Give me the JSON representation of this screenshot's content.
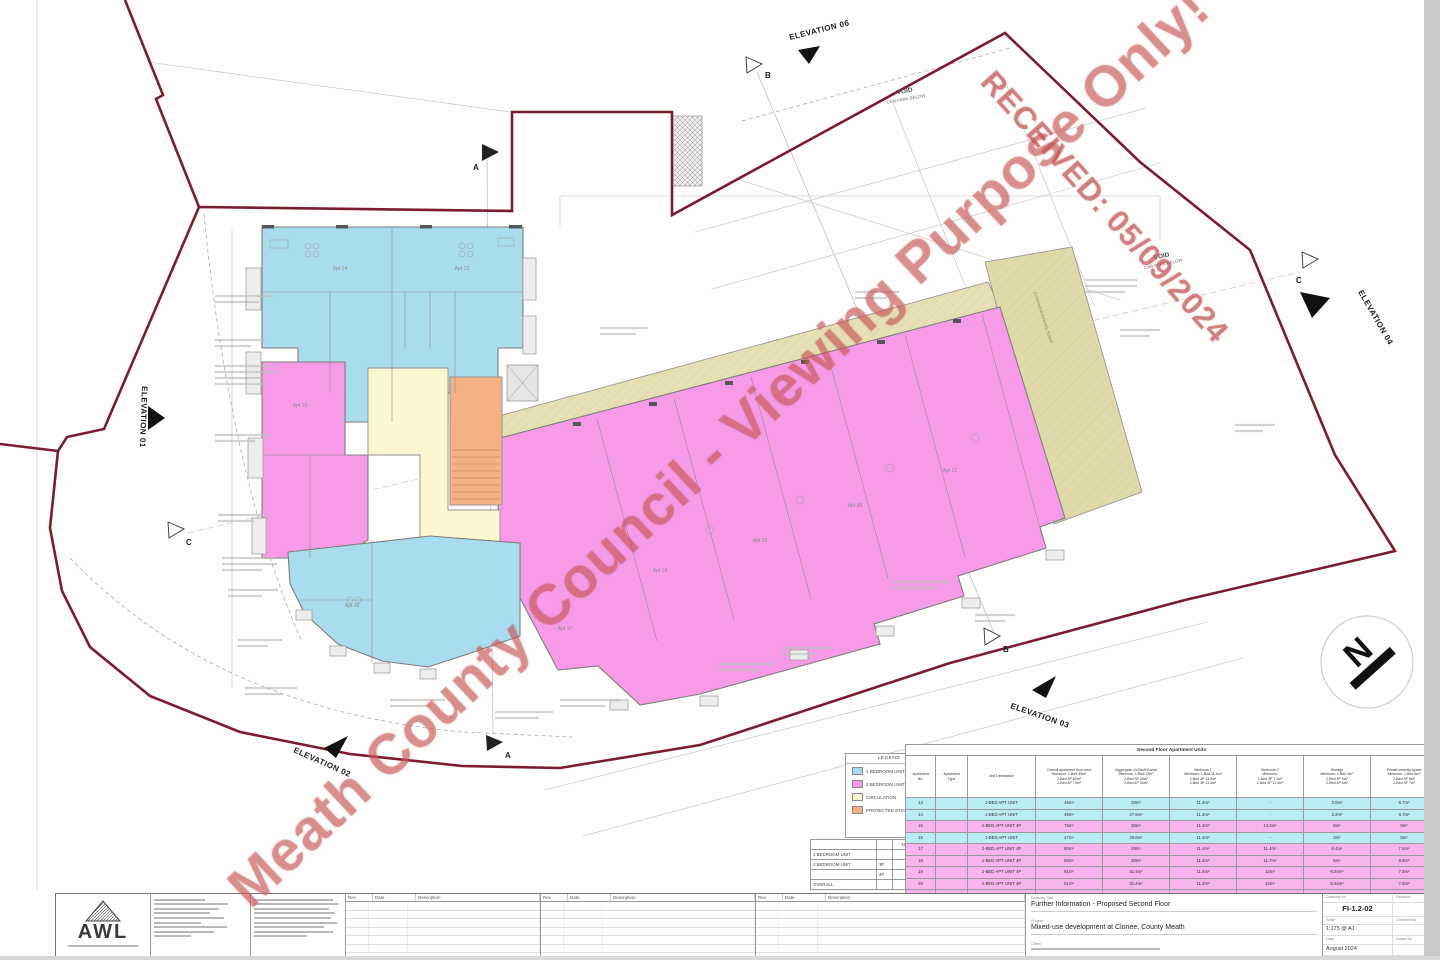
{
  "watermarks": {
    "main": "Meath County Council - Viewing Purpose Only!",
    "received": "RECEIVED: 05/09/2024"
  },
  "plan": {
    "void_title": "VOID",
    "void_sub": "CAR PARK BELOW",
    "elevation_01": "ELEVATION 01",
    "elevation_02": "ELEVATION 02",
    "elevation_03": "ELEVATION 03",
    "elevation_04": "ELEVATION 04",
    "elevation_06": "ELEVATION 06",
    "section_a": "A",
    "section_b": "B",
    "section_c": "C",
    "north_label": "N",
    "communal_label": "Communal Amenity Space",
    "units": [
      "Apt 14",
      "Apt 13",
      "Apt 15",
      "Apt 16",
      "Apt 17",
      "Apt 18",
      "Apt 19",
      "Apt 20",
      "Apt 21"
    ]
  },
  "legend": {
    "title": "LEGEND",
    "items": [
      {
        "label": "1 BEDROOM UNIT",
        "color": "#aadcf0"
      },
      {
        "label": "2 BEDROOM UNIT",
        "color": "#f79be8"
      },
      {
        "label": "CIRCULATION",
        "color": "#fbf7d0"
      },
      {
        "label": "PROTECTED STAIRWAY",
        "color": "#f5b183"
      }
    ]
  },
  "summary": {
    "number_header": "NUMBER",
    "rows": [
      [
        "1 BEDROOM UNIT",
        "",
        "3 No."
      ],
      [
        "2 BEDROOM UNIT",
        "3P",
        "1 No."
      ],
      [
        "",
        "4P",
        "5 No."
      ],
      [
        "OVERALL",
        "",
        "9 No."
      ]
    ]
  },
  "schedule": {
    "title": "Second Floor Apartment Units",
    "columns": [
      "Apartment\nNo.",
      "Apartment\nType",
      "Unit Description",
      "Overall apartment floor area\nMinimum: 1-Bed 45m²\n2-Bed 3P 63m²\n2-Bed 4P 73m²",
      "Aggregate Liv/Din/Kit area\nMinimum: 1-Bed 23m²\n2-Bed 3P 28m²\n2-Bed 4P 30m²",
      "Bedroom 1\nMinimum: 1-Bed 11.4m²\n2-Bed 3P 11.4m²\n2-Bed 4P 11.4m²",
      "Bedroom 2\nMinimum:\n2-Bed 3P 7.1m²\n2-Bed 4P 11.4m²",
      "Storage\nMinimum: 1-Bed 3m²\n2-Bed 3P 5m²\n2-Bed 4P 6m²",
      "Private amenity space\nMinimum: 1-Bed 5m²\n2-Bed 3P 6m²\n2-Bed 4P 7m²"
    ],
    "rows": [
      {
        "tint": "blue",
        "cells": [
          "13",
          "",
          "1-BED APT UNIT",
          "46m²",
          "28m²",
          "11.4m²",
          "-",
          "3.0m²",
          "5.7m²"
        ]
      },
      {
        "tint": "blue",
        "cells": [
          "14",
          "",
          "1-BED APT UNIT",
          "46m²",
          "27.5m²",
          "11.4m²",
          "-",
          "3.2m²",
          "5.7m²"
        ]
      },
      {
        "tint": "pink",
        "cells": [
          "15",
          "",
          "2-BED APT UNIT 4P",
          "75m²",
          "30m²",
          "11.4m²",
          "13.2m²",
          "6m²",
          "9m²"
        ]
      },
      {
        "tint": "blue",
        "cells": [
          "16",
          "",
          "1-BED APT UNIT",
          "47m²",
          "26.6m²",
          "11.4m²",
          "-",
          "3m²",
          "5m²"
        ]
      },
      {
        "tint": "pink",
        "cells": [
          "17",
          "",
          "2-BED APT UNIT 4P",
          "80m²",
          "28m²",
          "11.4m²",
          "11.4m²",
          "6.4m²",
          "7.8m²"
        ]
      },
      {
        "tint": "pink",
        "cells": [
          "18",
          "",
          "2-BED APT UNIT 4P",
          "80m²",
          "30m²",
          "11.4m²",
          "11.7m²",
          "6m²",
          "9.8m²"
        ]
      },
      {
        "tint": "pink",
        "cells": [
          "19",
          "",
          "2-BED APT UNIT 4P",
          "81m²",
          "31.4m²",
          "11.4m²",
          "12m²",
          "6.24m²",
          "7.5m²"
        ]
      },
      {
        "tint": "pink",
        "cells": [
          "20",
          "",
          "2-BED APT UNIT 4P",
          "81m²",
          "31.4m²",
          "11.4m²",
          "12m²",
          "6.24m²",
          "7.5m²"
        ]
      },
      {
        "tint": "pink",
        "cells": [
          "21",
          "",
          "2-BED APT UNIT 4P",
          "87m²",
          "31.4m²",
          "11.4m²",
          "12m²",
          "6.9m²",
          "14.3m²"
        ]
      }
    ]
  },
  "titleblock": {
    "logo": "AWL",
    "rev_headers": [
      "Rev",
      "Date",
      "Description"
    ],
    "drawing_title_label": "Drawing Title",
    "drawing_title": "Further Information - Proposed Second Floor",
    "project_label": "Project",
    "project": "Mixed-use development at Clonee, County Meath",
    "client_label": "Client",
    "drawing_no_label": "Drawing No",
    "drawing_no": "FI-1.2-02",
    "revision_label": "Revision",
    "scale_label": "Scale",
    "scale": "1:175 @ A1",
    "checked_label": "Checked by",
    "date_label": "Date",
    "date": "August 2024",
    "drawn_label": "Drawn by"
  }
}
